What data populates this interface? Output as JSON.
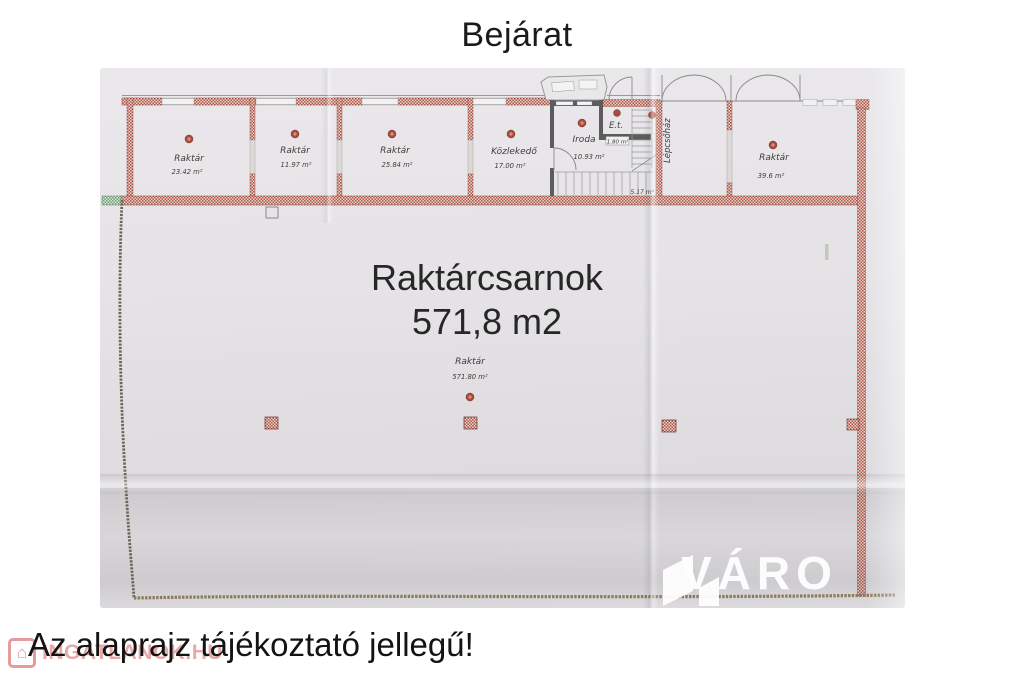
{
  "title": "Bejárat",
  "disclaimer": "Az alaprajz tájékoztató jellegű!",
  "hall": {
    "headline_line1": "Raktárcsarnok",
    "headline_line2": "571,8 m2",
    "label": "Raktár",
    "area": "571.80 m²"
  },
  "rooms": [
    {
      "name": "Raktár",
      "area": "23.42 m²"
    },
    {
      "name": "Raktár",
      "area": "11.97 m²"
    },
    {
      "name": "Raktár",
      "area": "25.84 m²"
    },
    {
      "name": "Közlekedő",
      "area": "17.00 m²"
    },
    {
      "name": "Iroda",
      "area": "10.93 m²"
    },
    {
      "name": "E.t.",
      "area": "1.80 m²"
    },
    {
      "name": "Lépcsőház",
      "area": "5.17 m²"
    },
    {
      "name": "Raktár",
      "area": "39.6 m²"
    }
  ],
  "watermarks": {
    "brand": "VÁRO",
    "portal": "INGATLANOK.HU"
  },
  "colors": {
    "wall_brick": "#ae5448",
    "wall_green": "#6d9c77",
    "paper": "#e6e4e7",
    "marker": "#a84a3c",
    "overlay_text": "#272727",
    "portal_red": "#cd4b4b"
  }
}
